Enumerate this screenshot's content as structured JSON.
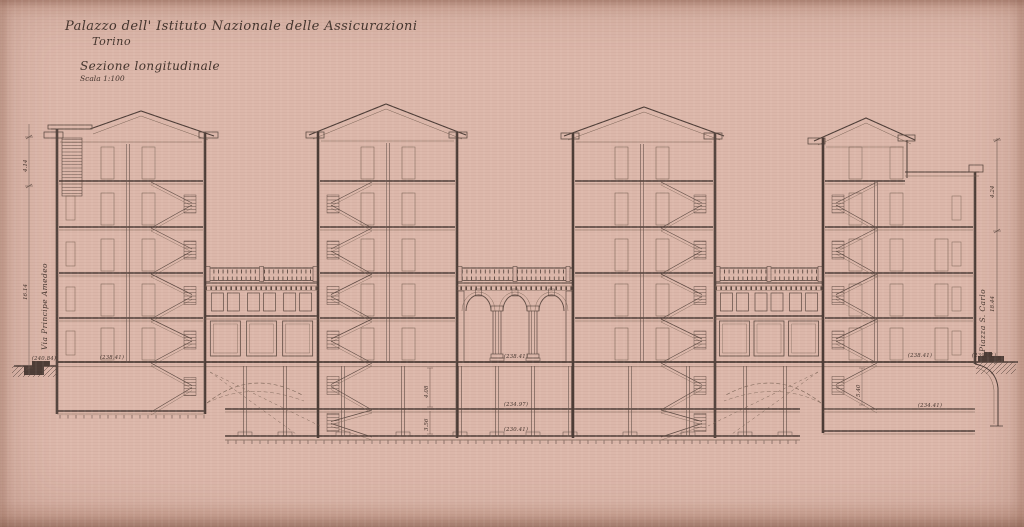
{
  "title_block": {
    "title": "Palazzo dell' Istituto Nazionale delle Assicurazioni",
    "city": "Torino",
    "drawing_name": "Sezione longitudinale",
    "scale": "Scala 1:100"
  },
  "street_labels": {
    "left": "Via Principe Amedeo",
    "right": "Piazza S. Carlo"
  },
  "elevation_marks": {
    "ground_center": "(238.41)",
    "basement_mid": "(234.97)",
    "basement_low": "(230.41)",
    "left_tower_base": "(238.41)",
    "street_left": "(240.84)",
    "right_wing_floor": "(238.41)",
    "street_right": "(239.41)",
    "right_lower_room": "(234.41)"
  },
  "dimension_marks": {
    "left_upper": "4.14",
    "left_lower": "16.14",
    "right_upper": "4.24",
    "right_lower": "18.44",
    "cellar_upper": "4.08",
    "cellar_lower": "3.56",
    "right_cellar": "5.40"
  },
  "colors": {
    "paper": "#d7b2a6",
    "ink": "#4c3c36"
  }
}
